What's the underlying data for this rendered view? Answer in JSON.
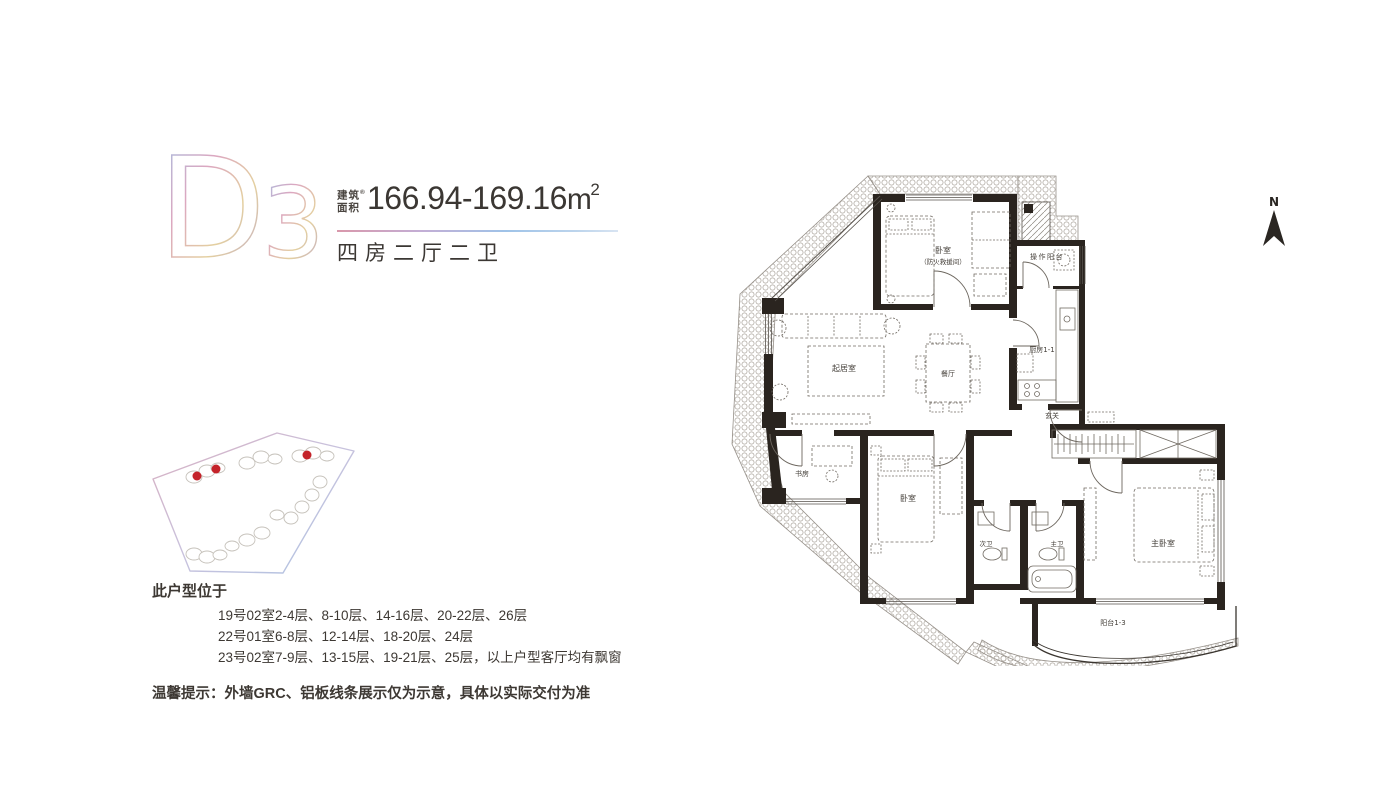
{
  "header": {
    "unit_letter": "D",
    "unit_digit": "3",
    "area_label_line1": "建筑",
    "area_label_line2": "面积",
    "area_note": "®",
    "area_value": "166.94-169.16",
    "area_unit": "m",
    "area_sup": "2",
    "layout_type": "四房二厅二卫"
  },
  "location": {
    "title": "此户型位于",
    "floor_lines": [
      "19号02室2-4层、8-10层、14-16层、20-22层、26层",
      "22号01室6-8层、12-14层、18-20层、24层",
      "23号02室7-9层、13-15层、19-21层、25层，以上户型客厅均有飘窗"
    ],
    "tip": "温馨提示：外墙GRC、铝板线条展示仅为示意，具体以实际交付为准"
  },
  "floor_plan": {
    "north_label": "N",
    "rooms": {
      "bedroom_fire": "卧室",
      "bedroom_fire_sub": "（防火救援间）",
      "operation_balcony": "操作阳台",
      "kitchen": "厨房1-1",
      "living_room": "起居室",
      "dining_room": "餐厅",
      "foyer": "玄关",
      "study": "书房",
      "bedroom_2": "卧室",
      "second_bath": "次卫",
      "master_bath": "主卫",
      "master_bedroom": "主卧室",
      "balcony": "阳台1-3"
    }
  },
  "colors": {
    "wall": "#2a241f",
    "text_primary": "#3d3833",
    "highlight_red": "#c4232a",
    "gradient_blue": "#9ec1e6",
    "gradient_pink": "#dca7c0",
    "gradient_gold": "#e4d0a0",
    "gradient_purple": "#b5a0d5"
  }
}
